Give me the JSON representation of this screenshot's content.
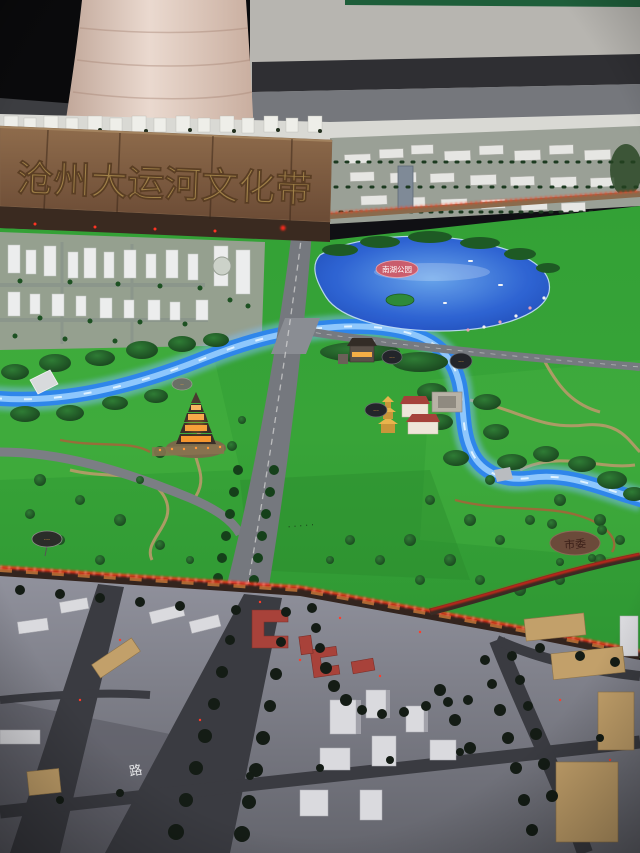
{
  "sign": {
    "title": "沧州大运河文化带"
  },
  "badges": {
    "lake": "南湖公园",
    "shiwei": "市委",
    "pavilion_1": "···",
    "pavilion_2": "···",
    "pagoda": "··",
    "compound": "···",
    "west": "···",
    "ground_text": "·····",
    "road_glyph": "路"
  },
  "colors": {
    "ceiling": "#0a0a0c",
    "wall": "#b7b5b0",
    "baseboard": "#2f2f33",
    "floor": "#75777c",
    "pillar": "#d9c6ba",
    "wood": "#82644a",
    "sign_text": "#a08148",
    "grass": "#38a438",
    "water": "#2f86ea",
    "water_glow": "#7fbef5",
    "lake_deep": "#2e62d8",
    "road": "#75787e",
    "road_dark": "#3a3b41",
    "led_red": "#ff2713",
    "badge_red": "#cf5b68",
    "badge_dark": "#23252a",
    "badge_text_orange": "#f5a93e",
    "shiwei_brown": "#6b4a3a",
    "urban": "#8e8f9a",
    "building_white": "#dadade",
    "building_red": "#a8423a",
    "building_tan": "#c2a06a",
    "tree_park": "#1d5a22",
    "tree_urban": "#141c15"
  }
}
